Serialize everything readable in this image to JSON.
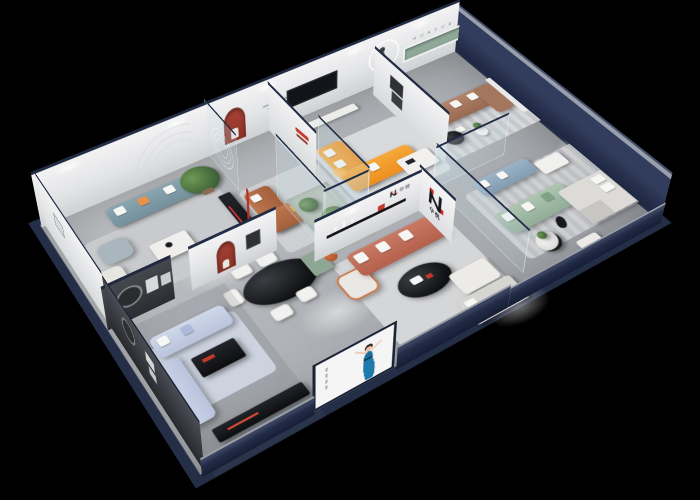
{
  "scene": {
    "type": "3d-isometric-showroom-cutaway-render",
    "description": "Cutaway axonometric 3D render of a furniture brand showroom with multiple furnished room vignettes on a black background",
    "background_color": "#000000"
  },
  "brand": {
    "name_cn": "华悦",
    "monogram": "N",
    "wall_letters": "H U A Y U E"
  },
  "palette": {
    "shell_navy": "#242e47",
    "floor_gray": "#b2b4b8",
    "wall_white": "#ebecee",
    "dark_feature_wall": "#3a3d42",
    "niche_red": "#9a372c",
    "niche_green": "#8fa899",
    "logo_red": "#d2261b",
    "sofa_orange": "#f29b2d",
    "sofa_caramel": "#b06a45",
    "sofa_rust": "#c0705a",
    "sofa_powder_blue": "#c7d0e6",
    "sofa_teal": "#7e9aa6",
    "sofa_steel_blue": "#8fa8bd",
    "sofa_sage": "#a3bca8",
    "sofa_brown": "#a97860",
    "table_black": "#14161a",
    "glass_tint": "#cfe2e6",
    "plant_green": "#4e7a46",
    "poster_dress_blue": "#1d6e9c"
  },
  "zones": [
    {
      "name": "living-display-teal",
      "items": [
        "teal-sofa",
        "white-sofa",
        "armchair",
        "coffee-table",
        "potted-tree",
        "media-console",
        "rug",
        "arc-wall-emboss"
      ]
    },
    {
      "name": "entry-lounge",
      "items": [
        "etched-glass-screen",
        "red-arch-niche",
        "bust-sculpture",
        "caramel-corner-sofa",
        "glass-coffee-table",
        "wall-slogan",
        "red-floor-lamp"
      ]
    },
    {
      "name": "orange-sofa-lounge",
      "items": [
        "orange-corner-sofa",
        "corner-lamp-glow",
        "white-coffee-table",
        "wall-tv",
        "tv-console",
        "rug"
      ]
    },
    {
      "name": "gallery-lounge",
      "items": [
        "brown-sofa-with-chaise",
        "runner-statue",
        "ring-wall-light",
        "green-display-niche",
        "wall-letters",
        "round-side-tables",
        "striped-rug"
      ]
    },
    {
      "name": "dining-area",
      "items": [
        "black-oval-dining-table",
        "white-chairs"
      ]
    },
    {
      "name": "powder-blue-living-bay",
      "items": [
        "powder-blue-sofa-set",
        "black-coffee-table",
        "dark-feature-wall",
        "round-wall-art",
        "media-console"
      ]
    },
    {
      "name": "bedroom-vignette",
      "items": [
        "rust-sofa",
        "white-pillows",
        "black-oval-coffee-table",
        "white-ottoman",
        "daybed",
        "armchair",
        "green-cabinet",
        "teddy-bear",
        "brand-logo-wall",
        "display-shelf"
      ]
    },
    {
      "name": "green-sofa-lounge",
      "items": [
        "sage-sofa",
        "steel-blue-sofa",
        "glass-partition",
        "round-coffee-table",
        "striped-rug",
        "bed-with-pillows",
        "white-ottoman"
      ]
    },
    {
      "name": "plant-display-case",
      "items": [
        "glass-case",
        "cacti-plants",
        "pebbles"
      ]
    },
    {
      "name": "front-facade",
      "items": [
        "woman-poster",
        "navy-shell-walls",
        "pale-wall-caps"
      ]
    }
  ]
}
